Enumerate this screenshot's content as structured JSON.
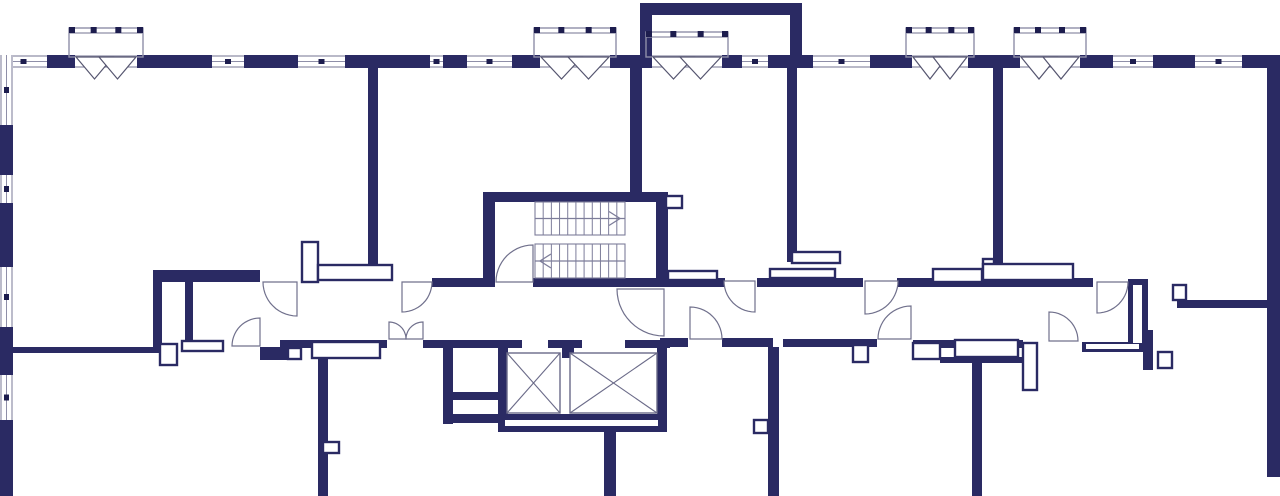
{
  "meta": {
    "description": "Architectural floor plan, corridor level with stair core and elevators"
  },
  "colors": {
    "wall": "#2a2a63",
    "line": "#8f8fa8",
    "door": "#70708c",
    "glyph": "#1d1d4e",
    "stair": "#7d7d9a",
    "bg": "#ffffff"
  },
  "canvas": {
    "width": 1280,
    "height": 496
  },
  "plan": {
    "walls": [
      [
        47,
        55,
        28,
        13
      ],
      [
        137,
        55,
        75,
        13
      ],
      [
        244,
        55,
        54,
        13
      ],
      [
        345,
        55,
        85,
        13
      ],
      [
        443,
        55,
        24,
        13
      ],
      [
        512,
        55,
        28,
        13
      ],
      [
        610,
        55,
        42,
        13
      ],
      [
        722,
        55,
        20,
        13
      ],
      [
        768,
        55,
        45,
        13
      ],
      [
        870,
        55,
        42,
        13
      ],
      [
        968,
        55,
        52,
        13
      ],
      [
        1080,
        55,
        33,
        13
      ],
      [
        1153,
        55,
        42,
        13
      ],
      [
        1242,
        55,
        38,
        13
      ],
      [
        0,
        125,
        13,
        50
      ],
      [
        0,
        203,
        13,
        64
      ],
      [
        0,
        327,
        13,
        48
      ],
      [
        0,
        420,
        13,
        76
      ],
      [
        1267,
        55,
        13,
        422
      ],
      [
        640,
        3,
        162,
        12
      ],
      [
        640,
        3,
        12,
        52
      ],
      [
        790,
        3,
        12,
        64
      ],
      [
        368,
        68,
        10,
        200
      ],
      [
        630,
        68,
        12,
        124
      ],
      [
        787,
        67,
        10,
        190
      ],
      [
        787,
        252,
        53,
        10
      ],
      [
        993,
        68,
        10,
        197
      ],
      [
        483,
        192,
        185,
        10
      ],
      [
        483,
        192,
        12,
        95
      ],
      [
        656,
        202,
        12,
        85
      ],
      [
        153,
        270,
        107,
        12
      ],
      [
        153,
        270,
        9,
        77
      ],
      [
        185,
        282,
        8,
        58
      ],
      [
        432,
        278,
        51,
        9
      ],
      [
        533,
        278,
        135,
        9
      ],
      [
        656,
        278,
        69,
        9
      ],
      [
        757,
        278,
        106,
        9
      ],
      [
        897,
        278,
        196,
        9
      ],
      [
        1128,
        279,
        20,
        71
      ],
      [
        1177,
        300,
        103,
        8
      ],
      [
        13,
        347,
        149,
        6
      ],
      [
        260,
        347,
        40,
        13
      ],
      [
        280,
        340,
        107,
        8
      ],
      [
        423,
        340,
        75,
        8
      ],
      [
        498,
        340,
        24,
        8
      ],
      [
        548,
        340,
        34,
        8
      ],
      [
        625,
        340,
        45,
        8
      ],
      [
        562,
        348,
        12,
        10
      ],
      [
        660,
        338,
        28,
        9
      ],
      [
        722,
        338,
        51,
        9
      ],
      [
        783,
        339,
        94,
        8
      ],
      [
        913,
        340,
        110,
        8
      ],
      [
        940,
        357,
        83,
        6
      ],
      [
        1082,
        342,
        61,
        10
      ],
      [
        1143,
        330,
        10,
        40
      ],
      [
        318,
        357,
        10,
        139
      ],
      [
        443,
        340,
        10,
        84
      ],
      [
        453,
        392,
        45,
        8
      ],
      [
        443,
        414,
        57,
        9
      ],
      [
        498,
        343,
        10,
        88
      ],
      [
        657,
        343,
        10,
        88
      ],
      [
        498,
        414,
        169,
        18
      ],
      [
        604,
        432,
        12,
        64
      ],
      [
        768,
        347,
        11,
        149
      ],
      [
        972,
        362,
        10,
        134
      ]
    ],
    "voids": [
      [
        505,
        420,
        153,
        6
      ],
      [
        1133,
        285,
        9,
        58
      ],
      [
        1086,
        344,
        53,
        5
      ]
    ],
    "windows_top": {
      "y": 55,
      "t": 13,
      "segments": [
        [
          0,
          47
        ],
        [
          212,
          32
        ],
        [
          298,
          47
        ],
        [
          430,
          13
        ],
        [
          467,
          45
        ],
        [
          742,
          26
        ],
        [
          813,
          57
        ],
        [
          1113,
          40
        ],
        [
          1195,
          47
        ]
      ]
    },
    "windows_left": {
      "x": 0,
      "t": 13,
      "segments": [
        [
          55,
          70
        ],
        [
          175,
          28
        ],
        [
          267,
          60
        ],
        [
          375,
          45
        ]
      ]
    },
    "balconies": [
      {
        "x": 75,
        "w": 62,
        "rail_top": 28
      },
      {
        "x": 540,
        "w": 70,
        "rail_top": 28
      },
      {
        "x": 652,
        "w": 70,
        "rail_top": 32
      },
      {
        "x": 912,
        "w": 56,
        "rail_top": 28
      },
      {
        "x": 1020,
        "w": 60,
        "rail_top": 28
      }
    ],
    "fixtures": [
      [
        302,
        242,
        16,
        40
      ],
      [
        318,
        265,
        74,
        15
      ],
      [
        160,
        344,
        17,
        21
      ],
      [
        182,
        341,
        41,
        10
      ],
      [
        288,
        348,
        13,
        11
      ],
      [
        312,
        342,
        68,
        16
      ],
      [
        666,
        196,
        16,
        12
      ],
      [
        668,
        271,
        49,
        9
      ],
      [
        770,
        269,
        65,
        9
      ],
      [
        792,
        252,
        48,
        11
      ],
      [
        933,
        269,
        49,
        13
      ],
      [
        983,
        259,
        11,
        23
      ],
      [
        983,
        264,
        90,
        16
      ],
      [
        853,
        345,
        15,
        17
      ],
      [
        754,
        420,
        14,
        13
      ],
      [
        323,
        442,
        16,
        11
      ],
      [
        955,
        340,
        63,
        17
      ],
      [
        913,
        343,
        27,
        16
      ],
      [
        1023,
        343,
        14,
        47
      ],
      [
        1158,
        352,
        14,
        16
      ],
      [
        1173,
        285,
        13,
        15
      ]
    ],
    "stairs": {
      "x": 535,
      "w": 90,
      "flights": [
        {
          "y": 202,
          "h": 33,
          "arrow": "right"
        },
        {
          "y": 244,
          "h": 34,
          "arrow": "left"
        }
      ],
      "treads": 11
    },
    "elevators": [
      [
        507,
        353,
        53,
        60
      ],
      [
        570,
        353,
        87,
        60
      ]
    ],
    "doors": [
      {
        "hx": 297,
        "hy": 282,
        "r": 34,
        "a0": 90,
        "a1": 180
      },
      {
        "hx": 402,
        "hy": 282,
        "r": 30,
        "a0": 0,
        "a1": 90
      },
      {
        "hx": 755,
        "hy": 281,
        "r": 31,
        "a0": 90,
        "a1": 180
      },
      {
        "hx": 865,
        "hy": 281,
        "r": 33,
        "a0": 0,
        "a1": 90
      },
      {
        "hx": 1097,
        "hy": 282,
        "r": 31,
        "a0": 0,
        "a1": 90
      },
      {
        "hx": 664,
        "hy": 289,
        "r": 47,
        "a0": 90,
        "a1": 180
      },
      {
        "hx": 533,
        "hy": 282,
        "r": 37,
        "a0": 180,
        "a1": 270
      },
      {
        "hx": 260,
        "hy": 346,
        "r": 28,
        "a0": 180,
        "a1": 270
      },
      {
        "hx": 389,
        "hy": 339,
        "r": 17,
        "a0": 270,
        "a1": 360
      },
      {
        "hx": 423,
        "hy": 339,
        "r": 17,
        "a0": 180,
        "a1": 270
      },
      {
        "hx": 690,
        "hy": 339,
        "r": 32,
        "a0": 270,
        "a1": 360
      },
      {
        "hx": 911,
        "hy": 339,
        "r": 33,
        "a0": 180,
        "a1": 270
      },
      {
        "hx": 1049,
        "hy": 341,
        "r": 29,
        "a0": 270,
        "a1": 360
      }
    ]
  }
}
